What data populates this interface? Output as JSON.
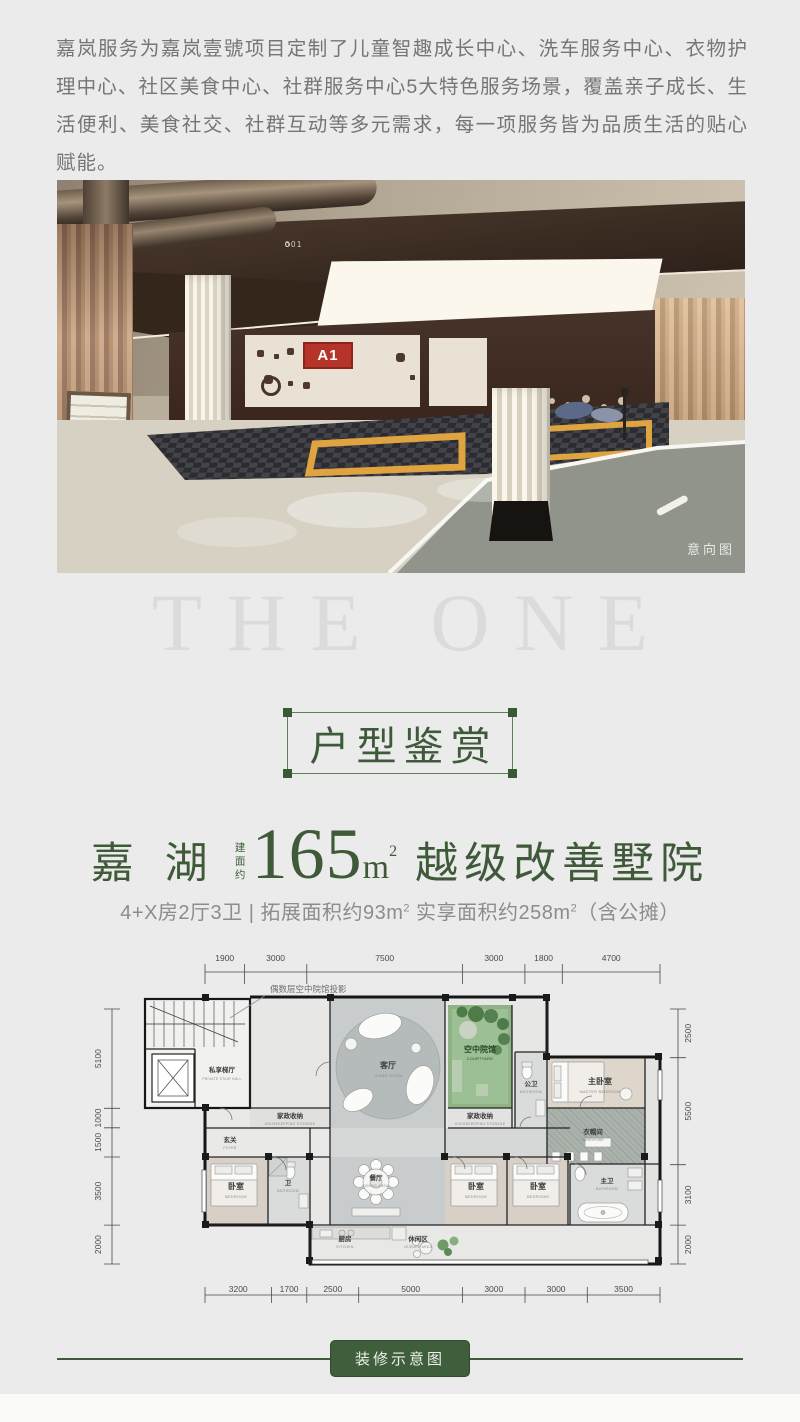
{
  "colors": {
    "page_bg": "#ebebeb",
    "accent_green": "#3e5a38",
    "badge_green": "#3f5e3b",
    "a1_red": "#b5342a",
    "courtyard_green": "#8fb287"
  },
  "intro": {
    "text": "嘉岚服务为嘉岚壹號项目定制了儿童智趣成长中心、洗车服务中心、衣物护理中心、社区美食中心、社群服务中心5大特色服务场景，覆盖亲子成长、生活便利、美食社交、社群互动等多元需求，每一项服务皆为品质生活的贴心赋能。"
  },
  "photo": {
    "watermark": "意向图",
    "sign_a1": "A1",
    "sign_001": "001"
  },
  "watermark": {
    "title": "THE ONE"
  },
  "section": {
    "title": "户型鉴赏"
  },
  "headline": {
    "name": "嘉 湖",
    "area_prefix": "建面约",
    "area_value": "165",
    "area_unit": "m",
    "area_sup": "2",
    "tagline": "越级改善墅院"
  },
  "subline": {
    "part1": "4+X房2厅3卫 | 拓展面积约93m",
    "sup1": "2",
    "part2": " 实享面积约258m",
    "sup2": "2",
    "part3": "（含公摊）"
  },
  "floor_plan": {
    "annotation": "偶数层空中院馆投影",
    "badge": "装修示意图",
    "dims_top": [
      "1900",
      "3000",
      "7500",
      "3000",
      "1800",
      "4700"
    ],
    "dims_bottom": [
      "3200",
      "1700",
      "2500",
      "5000",
      "3000",
      "3000",
      "3500"
    ],
    "dims_left": [
      "5100",
      "1000",
      "1500",
      "3500",
      "2000"
    ],
    "dims_right": [
      "2500",
      "5500",
      "3100",
      "2000"
    ],
    "rooms": [
      {
        "cn": "私享梯厅",
        "en": "PRIVATE STAIR HALL"
      },
      {
        "cn": "玄关",
        "en": "FOYER"
      },
      {
        "cn": "家政收纳",
        "en": "HOUSEKEEPING STORAGE"
      },
      {
        "cn": "客厅",
        "en": "LIVING ROOM"
      },
      {
        "cn": "空中院馆",
        "en": "COURTYARD"
      },
      {
        "cn": "家政收纳",
        "en": "HOUSEKEEPING STORAGE"
      },
      {
        "cn": "公卫",
        "en": "BATHROOM"
      },
      {
        "cn": "主卧室",
        "en": "MASTER BEDROOM"
      },
      {
        "cn": "衣帽间",
        "en": "WARDROBE"
      },
      {
        "cn": "卧室",
        "en": "BEDROOM"
      },
      {
        "cn": "卫",
        "en": "BATHROOM"
      },
      {
        "cn": "餐厅",
        "en": "DINING AREA"
      },
      {
        "cn": "卧室",
        "en": "BEDROOM"
      },
      {
        "cn": "卧室",
        "en": "BEDROOM"
      },
      {
        "cn": "主卫",
        "en": "BATHROOM"
      },
      {
        "cn": "厨房",
        "en": "KITCHEN"
      },
      {
        "cn": "休闲区",
        "en": "LEISURE AREA"
      }
    ]
  }
}
